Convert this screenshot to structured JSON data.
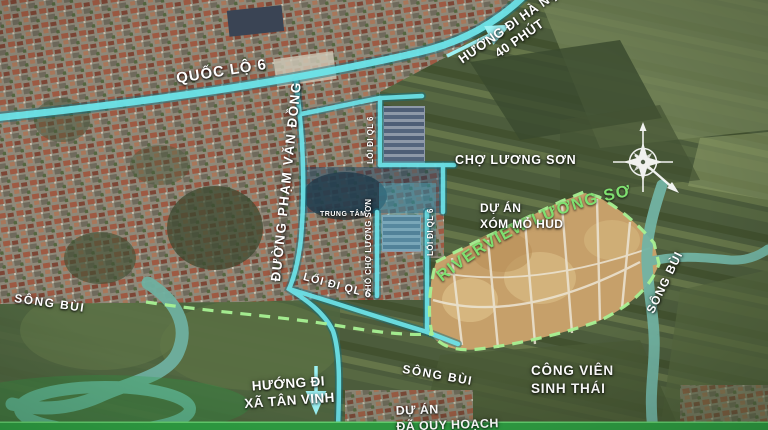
{
  "title": "RIVERVIEW LƯƠNG SƠN",
  "labels": {
    "highway": "QUỐC LỘ 6",
    "hanoi_line1": "HƯỚNG ĐI HÀ NỘI",
    "hanoi_line2": "40 PHÚT",
    "pham_van_dong": "ĐƯỜNG PHẠM VĂN ĐỒNG",
    "market": "CHỢ LƯƠNG SƠN",
    "hud_line1": "DỰ ÁN",
    "hud_line2": "XÓM MỎ HUD",
    "project": "RIVERVIEW LƯƠNG SƠN",
    "river_east": "SÔNG BÙI",
    "river_west": "SÔNG BÙI",
    "river_south": "SÔNG BÙI",
    "center_hub": "TRUNG TÂM",
    "alley_ql6_upper": "LỐI ĐI QL 6",
    "alley_ql6_right": "LỐI ĐI QL 6",
    "alley_ql6_main": "LỐI ĐI QL 6",
    "market_street": "PHỐ CHỢ LƯƠNG SƠN",
    "tanvinh_line1": "HƯỚNG ĐI",
    "tanvinh_line2": "XÃ TÂN VINH",
    "park_line1": "CÔNG VIÊN",
    "park_line2": "SINH THÁI",
    "planned_line1": "DỰ ÁN",
    "planned_line2": "ĐÃ QUY HOẠCH"
  },
  "colors": {
    "road_highlight": "#6ee6ec",
    "road_arrow": "#9df2f4",
    "boundary_dash": "#a8f193",
    "project_text": "#7fe070",
    "water": "#6fb0a0",
    "project_land": "#c6a06a",
    "bottom_bar": "#2f9f43"
  }
}
